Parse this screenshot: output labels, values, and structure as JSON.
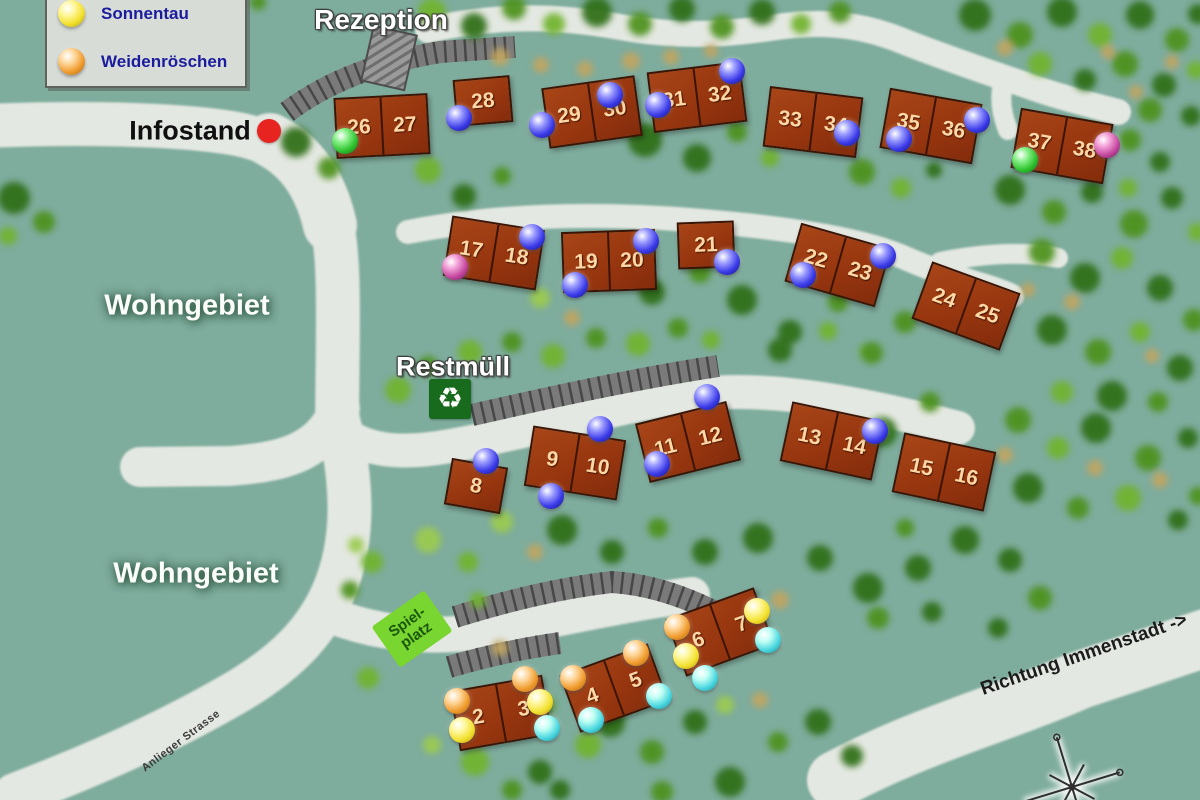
{
  "legend": {
    "items": [
      {
        "label": "Sonnentau",
        "color": "yellow"
      },
      {
        "label": "Weidenröschen",
        "color": "orange"
      }
    ]
  },
  "labels": {
    "rezeption": "Rezeption",
    "infostand": "Infostand",
    "wohngebiet_upper": "Wohngebiet",
    "wohngebiet_lower": "Wohngebiet",
    "restmuell": "Restmüll",
    "spielplatz_line1": "Spiel-",
    "spielplatz_line2": "platz",
    "richtung": "Richtung Immenstadt ->",
    "anlieger": "Anlieger Strasse"
  },
  "icons": {
    "recycle": "♻"
  },
  "colors": {
    "blue": {
      "light": "#9a9aff",
      "base": "#3a3ae8",
      "dark": "#12127a"
    },
    "green": {
      "light": "#88f088",
      "base": "#2ec22e",
      "dark": "#0e6a0e"
    },
    "magenta": {
      "light": "#f2a0d8",
      "base": "#c4489e",
      "dark": "#6e1060"
    },
    "yellow": {
      "light": "#fff7a0",
      "base": "#f2e12e",
      "dark": "#b09310"
    },
    "orange": {
      "light": "#ffd9a0",
      "base": "#f09c2e",
      "dark": "#a86410"
    },
    "cyan": {
      "light": "#c2fff4",
      "base": "#4cd8e0",
      "dark": "#148898"
    },
    "infostand_marker": "#e82420"
  },
  "houses": [
    {
      "x": 382,
      "y": 126,
      "rot": -3,
      "units": [
        "26",
        "27"
      ],
      "balls": [
        {
          "color": "green",
          "dx": -37,
          "dy": 15
        }
      ]
    },
    {
      "x": 483,
      "y": 101,
      "rot": -5,
      "units": [
        "28"
      ],
      "balls": [
        {
          "color": "blue",
          "dx": -24,
          "dy": 17
        }
      ]
    },
    {
      "x": 592,
      "y": 112,
      "rot": -8,
      "units": [
        "29",
        "30"
      ],
      "balls": [
        {
          "color": "blue",
          "dx": -50,
          "dy": 13
        },
        {
          "color": "blue",
          "dx": 18,
          "dy": -17
        }
      ]
    },
    {
      "x": 697,
      "y": 97,
      "rot": -7,
      "units": [
        "31",
        "32"
      ],
      "balls": [
        {
          "color": "blue",
          "dx": -39,
          "dy": 8
        },
        {
          "color": "blue",
          "dx": 35,
          "dy": -26
        }
      ]
    },
    {
      "x": 813,
      "y": 122,
      "rot": 7,
      "units": [
        "33",
        "34"
      ],
      "balls": [
        {
          "color": "blue",
          "dx": 34,
          "dy": 11
        }
      ]
    },
    {
      "x": 931,
      "y": 126,
      "rot": 10,
      "units": [
        "35",
        "36"
      ],
      "balls": [
        {
          "color": "blue",
          "dx": -32,
          "dy": 13
        },
        {
          "color": "blue",
          "dx": 46,
          "dy": -6
        }
      ]
    },
    {
      "x": 1062,
      "y": 146,
      "rot": 10,
      "units": [
        "37",
        "38"
      ],
      "balls": [
        {
          "color": "green",
          "dx": -37,
          "dy": 14
        },
        {
          "color": "magenta",
          "dx": 45,
          "dy": -1
        }
      ]
    },
    {
      "x": 494,
      "y": 253,
      "rot": 9,
      "units": [
        "17",
        "18"
      ],
      "balls": [
        {
          "color": "magenta",
          "dx": -39,
          "dy": 14
        },
        {
          "color": "blue",
          "dx": 38,
          "dy": -16
        }
      ]
    },
    {
      "x": 609,
      "y": 261,
      "rot": -2,
      "units": [
        "19",
        "20"
      ],
      "balls": [
        {
          "color": "blue",
          "dx": -34,
          "dy": 24
        },
        {
          "color": "blue",
          "dx": 37,
          "dy": -20
        }
      ]
    },
    {
      "x": 706,
      "y": 245,
      "rot": -2,
      "units": [
        "21"
      ],
      "balls": [
        {
          "color": "blue",
          "dx": 21,
          "dy": 17
        }
      ]
    },
    {
      "x": 838,
      "y": 265,
      "rot": 16,
      "units": [
        "22",
        "23"
      ],
      "balls": [
        {
          "color": "blue",
          "dx": -35,
          "dy": 10
        },
        {
          "color": "blue",
          "dx": 45,
          "dy": -9
        }
      ]
    },
    {
      "x": 966,
      "y": 306,
      "rot": 20,
      "units": [
        "24",
        "25"
      ],
      "balls": []
    },
    {
      "x": 476,
      "y": 486,
      "rot": 10,
      "units": [
        "8"
      ],
      "balls": [
        {
          "color": "blue",
          "dx": 10,
          "dy": -25
        }
      ]
    },
    {
      "x": 575,
      "y": 463,
      "rot": 9,
      "units": [
        "9",
        "10"
      ],
      "balls": [
        {
          "color": "blue",
          "dx": -24,
          "dy": 33
        },
        {
          "color": "blue",
          "dx": 25,
          "dy": -34
        }
      ]
    },
    {
      "x": 688,
      "y": 442,
      "rot": -14,
      "units": [
        "11",
        "12"
      ],
      "balls": [
        {
          "color": "blue",
          "dx": -31,
          "dy": 22
        },
        {
          "color": "blue",
          "dx": 19,
          "dy": -45
        }
      ]
    },
    {
      "x": 832,
      "y": 441,
      "rot": 12,
      "units": [
        "13",
        "14"
      ],
      "balls": [
        {
          "color": "blue",
          "dx": 43,
          "dy": -10
        }
      ]
    },
    {
      "x": 944,
      "y": 472,
      "rot": 12,
      "units": [
        "15",
        "16"
      ],
      "balls": []
    },
    {
      "x": 501,
      "y": 713,
      "rot": -10,
      "units": [
        "2",
        "3"
      ],
      "balls": [
        {
          "color": "orange",
          "dx": -44,
          "dy": -12
        },
        {
          "color": "yellow",
          "dx": -39,
          "dy": 17
        },
        {
          "color": "orange",
          "dx": 24,
          "dy": -34
        },
        {
          "color": "yellow",
          "dx": 39,
          "dy": -11
        },
        {
          "color": "cyan",
          "dx": 46,
          "dy": 15
        }
      ]
    },
    {
      "x": 614,
      "y": 688,
      "rot": -20,
      "units": [
        "4",
        "5"
      ],
      "balls": [
        {
          "color": "orange",
          "dx": -41,
          "dy": -10
        },
        {
          "color": "cyan",
          "dx": -23,
          "dy": 32
        },
        {
          "color": "orange",
          "dx": 22,
          "dy": -35
        },
        {
          "color": "cyan",
          "dx": 45,
          "dy": 8
        }
      ]
    },
    {
      "x": 720,
      "y": 632,
      "rot": -20,
      "units": [
        "6",
        "7"
      ],
      "balls": [
        {
          "color": "orange",
          "dx": -43,
          "dy": -5
        },
        {
          "color": "yellow",
          "dx": -34,
          "dy": 24
        },
        {
          "color": "cyan",
          "dx": -15,
          "dy": 46
        },
        {
          "color": "yellow",
          "dx": 37,
          "dy": -21
        },
        {
          "color": "cyan",
          "dx": 48,
          "dy": 8
        }
      ]
    }
  ]
}
